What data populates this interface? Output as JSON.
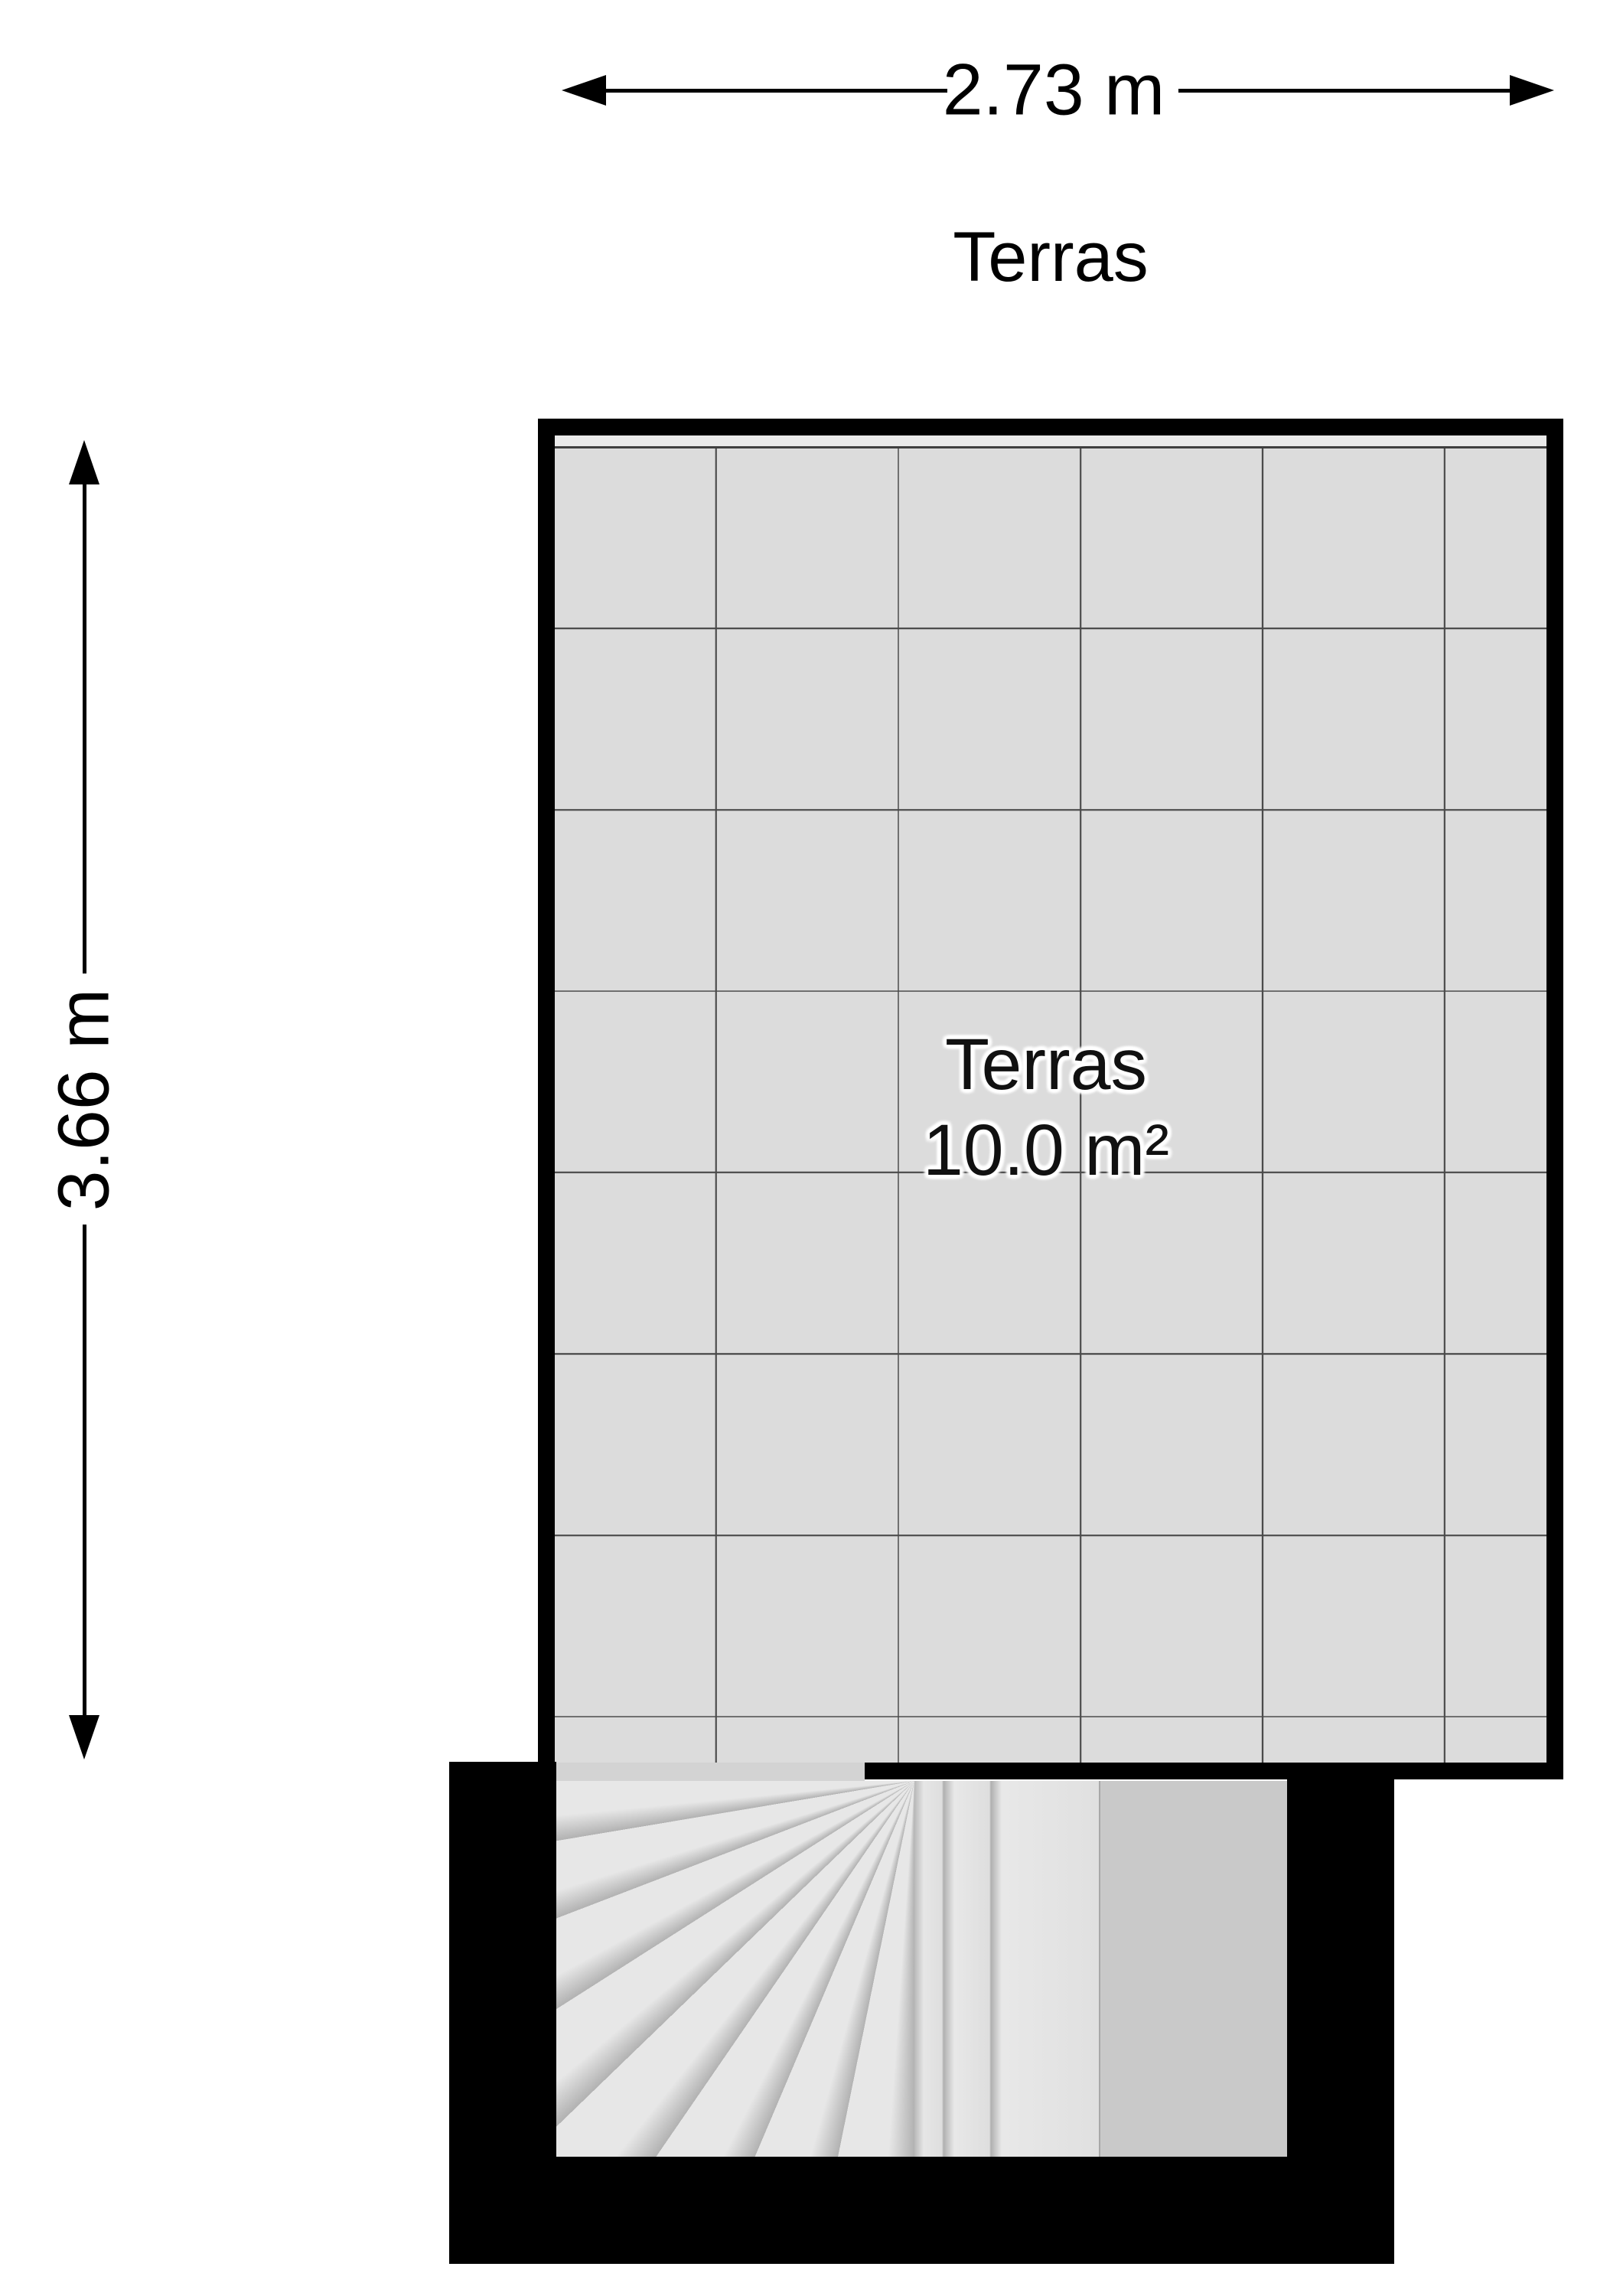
{
  "floor_plan": {
    "title": "Terras",
    "room": {
      "name": "Terras",
      "area": "10.0 m²"
    },
    "dimensions": {
      "width_label": "2.73 m",
      "height_label": "3.66 m"
    }
  },
  "colors": {
    "wall": "#000000",
    "bg": "#ffffff",
    "tile": "#dcdcdc",
    "grid": "#4a4a4a",
    "strip": "#eaeaea",
    "stripline": "#3f3f3f",
    "threshold": "#d3d3d3",
    "stairlight": "#e7e7e7",
    "stairshadow": "#b2b2b2",
    "landing": "#c9c9c9",
    "text": "#000000",
    "labeltext": "#111111",
    "outline": "#ffffff"
  }
}
